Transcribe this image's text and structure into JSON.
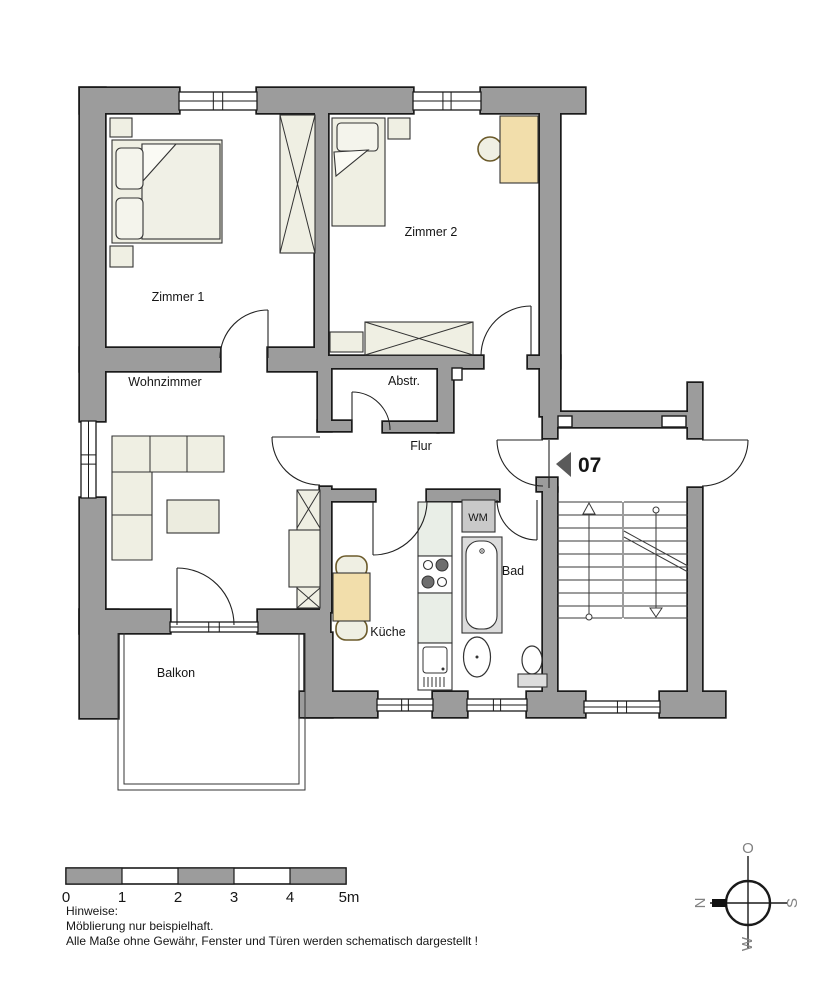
{
  "rooms": {
    "zimmer1": "Zimmer 1",
    "zimmer2": "Zimmer 2",
    "wohnzimmer": "Wohnzimmer",
    "abstellraum": "Abstr.",
    "flur": "Flur",
    "kueche": "Küche",
    "bad": "Bad",
    "balkon": "Balkon"
  },
  "fixtures": {
    "washing_machine": "WM"
  },
  "entrance": {
    "apartment_number": "07"
  },
  "scale_bar": {
    "ticks": [
      "0",
      "1",
      "2",
      "3",
      "4",
      "5m"
    ]
  },
  "notes": {
    "heading": "Hinweise:",
    "lines": [
      "Möblierung nur beispielhaft.",
      "Alle Maße ohne Gewähr, Fenster und Türen werden schematisch dargestellt !"
    ]
  },
  "compass": {
    "top": "O",
    "left": "N",
    "right": "S",
    "bottom": "W"
  },
  "colors": {
    "wall": "#9c9c9c",
    "outline": "#1a1a1a",
    "furniture": "#efefe3",
    "furniture_light": "#f4f4ec",
    "wood": "#f2deab",
    "counter": "#e9eee7",
    "appliance_gray": "#c9c9c9",
    "tub_gray": "#dcdcdc"
  }
}
